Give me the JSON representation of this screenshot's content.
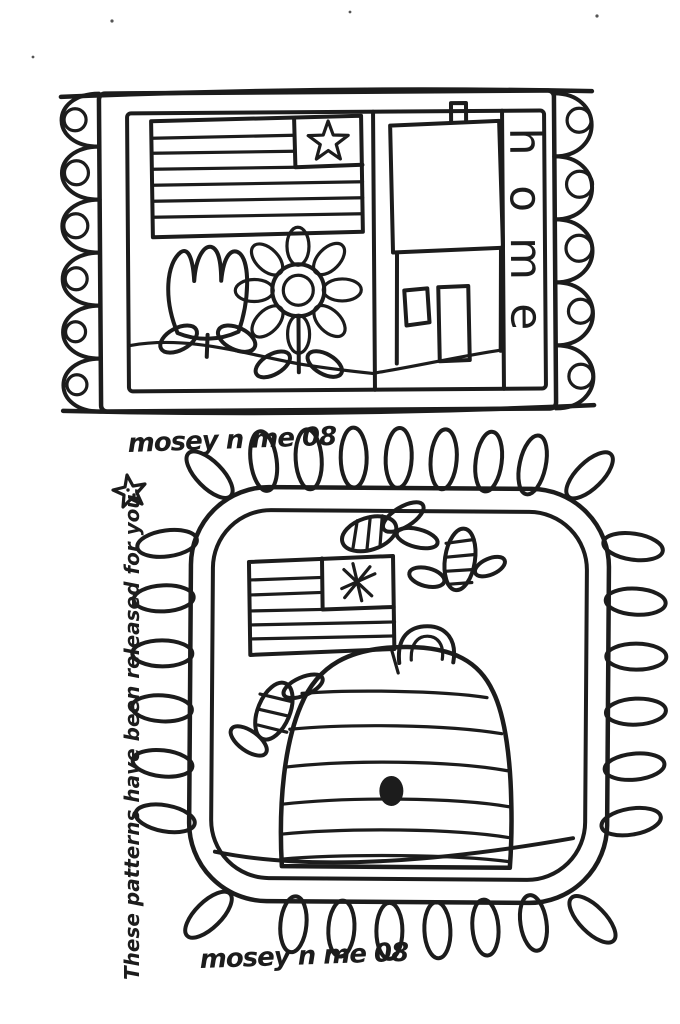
{
  "page": {
    "background": "#ffffff",
    "ink_color": "#1c1c1c"
  },
  "signatures": {
    "top": "mosey n me 08",
    "bottom": "mosey n me 08"
  },
  "side_note": {
    "text": "These patterns have been released for you."
  },
  "top_rug": {
    "word_vertical": "home",
    "letters": [
      "h",
      "o",
      "m",
      "e"
    ]
  }
}
